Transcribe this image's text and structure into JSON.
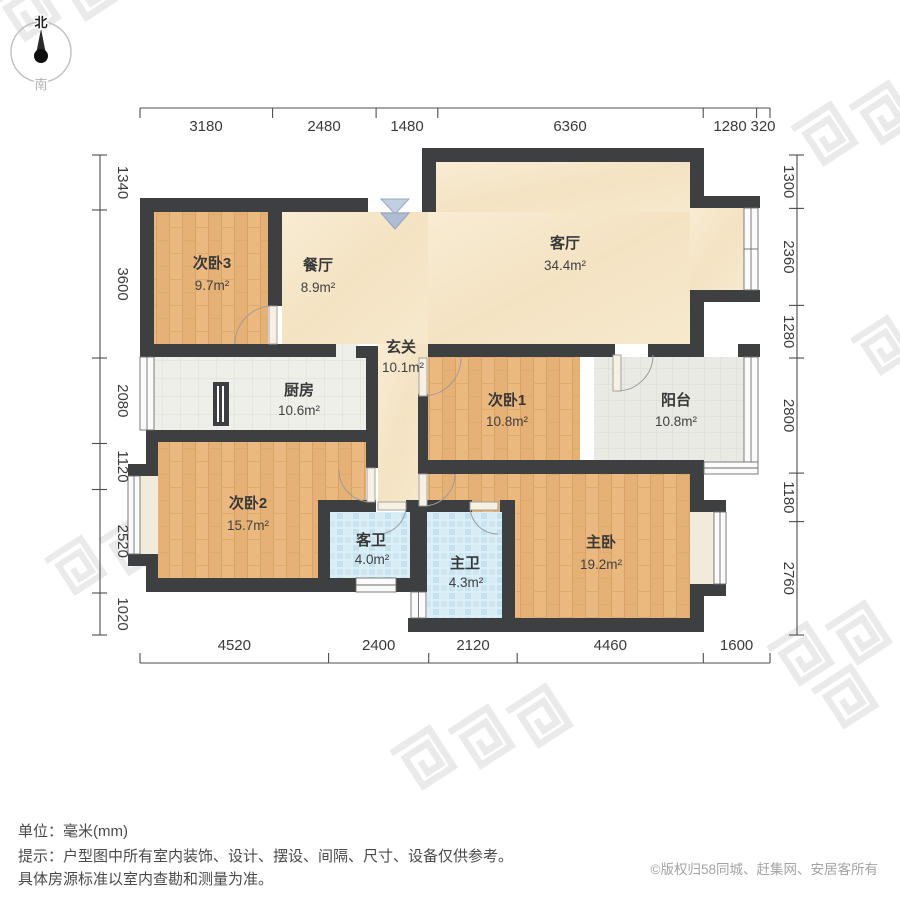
{
  "compass": {
    "north": "北",
    "south": "南"
  },
  "dimensions": {
    "unit_note": "单位：毫米(mm)",
    "top": [
      "3180",
      "2480",
      "1480",
      "6360",
      "1280",
      "320"
    ],
    "left": [
      "1340",
      "3600",
      "2080",
      "1120",
      "2520",
      "1020"
    ],
    "right": [
      "1300",
      "2360",
      "1280",
      "2800",
      "1180",
      "2760"
    ],
    "bottom": [
      "4520",
      "2400",
      "2120",
      "4460",
      "1600"
    ]
  },
  "rooms": [
    {
      "name": "次卧3",
      "area": "9.7m²"
    },
    {
      "name": "餐厅",
      "area": "8.9m²"
    },
    {
      "name": "客厅",
      "area": "34.4m²"
    },
    {
      "name": "玄关",
      "area": "10.1m²"
    },
    {
      "name": "厨房",
      "area": "10.6m²"
    },
    {
      "name": "次卧1",
      "area": "10.8m²"
    },
    {
      "name": "阳台",
      "area": "10.8m²"
    },
    {
      "name": "次卧2",
      "area": "15.7m²"
    },
    {
      "name": "客卫",
      "area": "4.0m²"
    },
    {
      "name": "主卫",
      "area": "4.3m²"
    },
    {
      "name": "主卧",
      "area": "19.2m²"
    }
  ],
  "footer": {
    "unit": "单位：毫米(mm)",
    "tip_line1": "提示：户型图中所有室内装饰、设计、摆设、间隔、尺寸、设备仅供参考。",
    "tip_line2": "具体房源标准以室内查勘和测量为准。",
    "copyright": "©版权归58同城、赶集网、安居客所有"
  },
  "colors": {
    "wall": "#3e3f41",
    "wood_floor": "#eab87e",
    "marble_floor": "#f6e7ca",
    "tile_floor": "#efefea",
    "bath_tile": "#d8ecf5",
    "bay_fill": "#f1ebdc",
    "entrance_arrow": "#aebdd3",
    "dimension_text": "#3a3a3a",
    "copyright_text": "#a3a3a3"
  }
}
